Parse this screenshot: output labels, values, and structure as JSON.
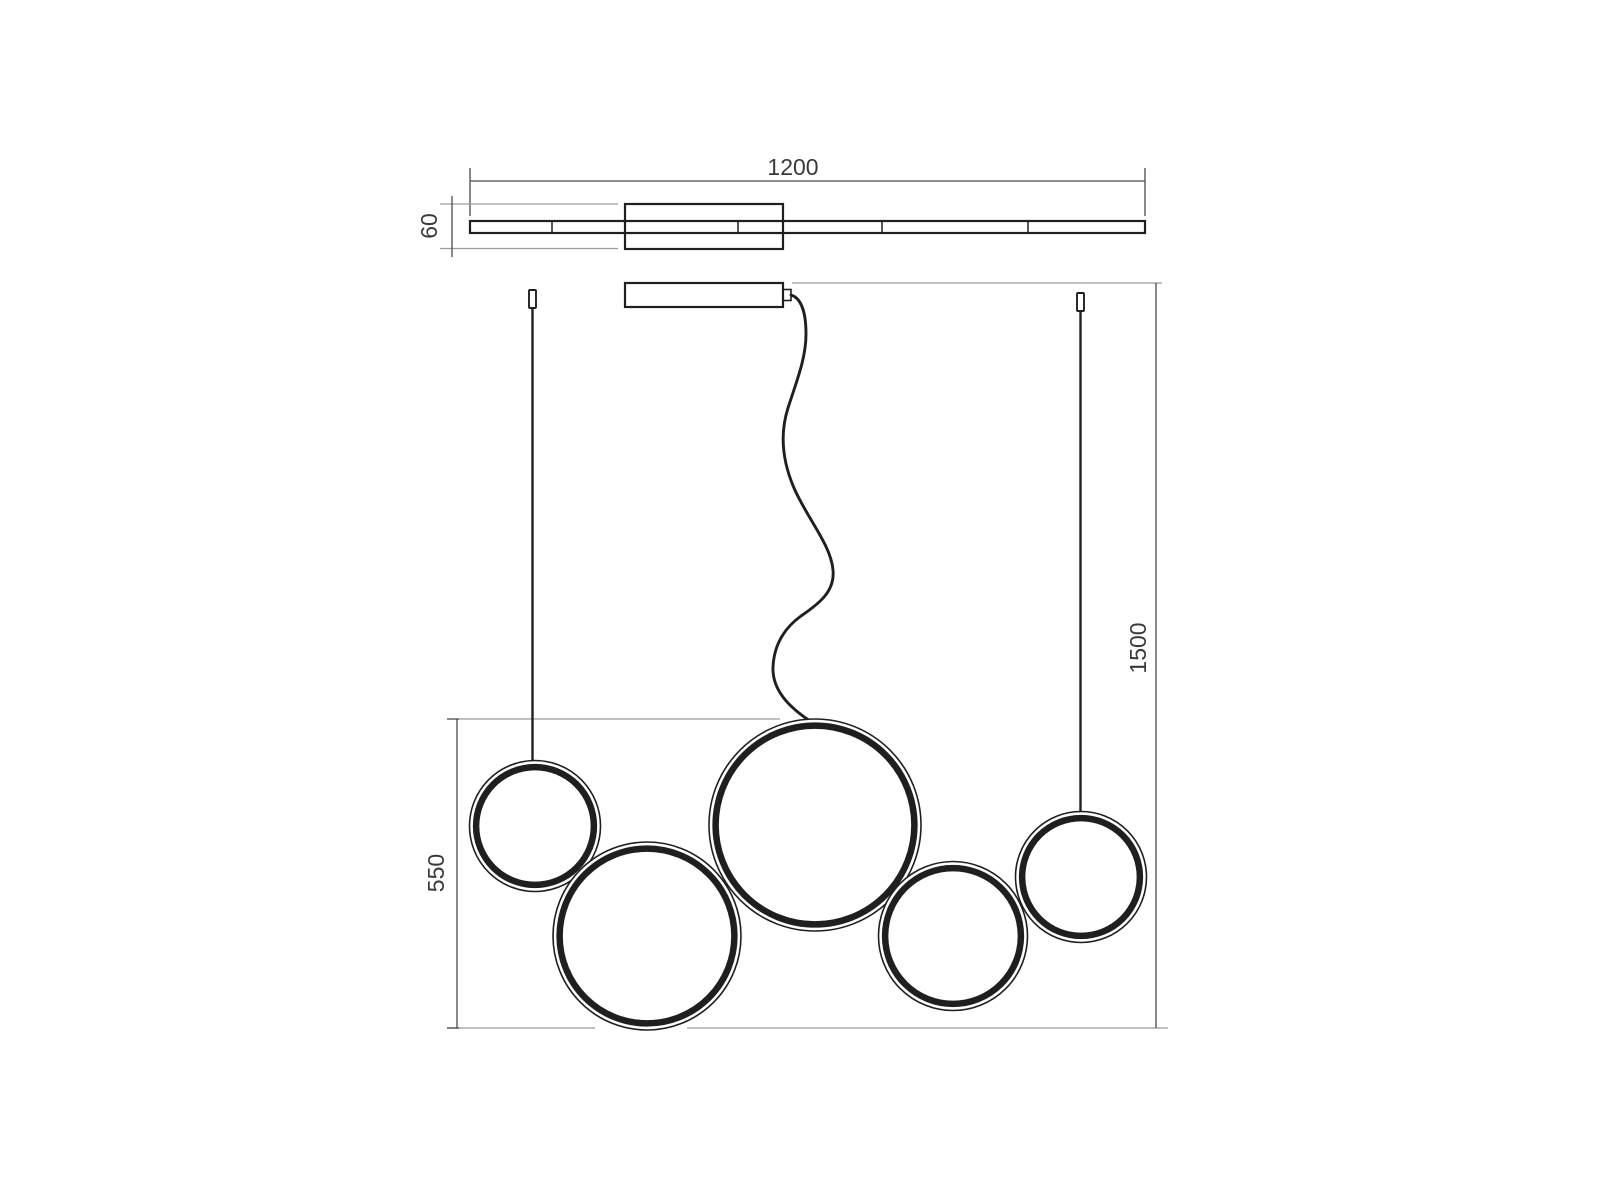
{
  "dimensions": {
    "width": "1200",
    "canopy_depth": "60",
    "ring_cluster_height": "550",
    "suspension_drop": "1500"
  },
  "figure": {
    "type": "technical-drawing",
    "views": 2,
    "ring_count": 5
  },
  "colors": {
    "background": "#ffffff",
    "object_line": "#1f1f1f",
    "dimension_line": "#4a4a4a",
    "extension_line": "#9a9a9a",
    "label_text": "#3a3a3a"
  }
}
